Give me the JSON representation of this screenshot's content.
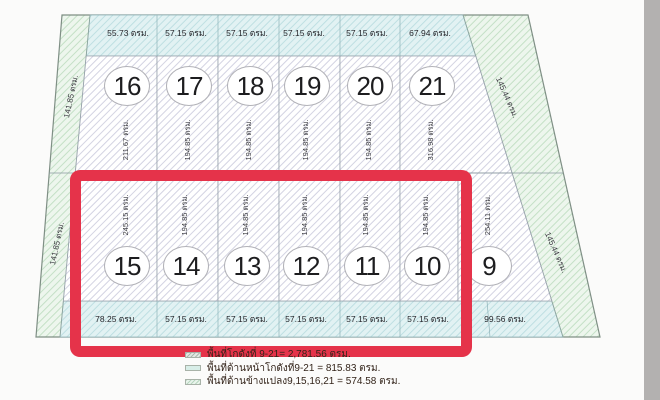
{
  "top_strip": [
    "55.73 ตรม.",
    "57.15 ตรม.",
    "57.15 ตรม.",
    "57.15 ตรม.",
    "57.15 ตรม.",
    "67.94 ตรม."
  ],
  "top_plots": [
    {
      "number": "16",
      "area": "211.67 ตรม."
    },
    {
      "number": "17",
      "area": "194.85 ตรม."
    },
    {
      "number": "18",
      "area": "194.85 ตรม."
    },
    {
      "number": "19",
      "area": "194.85 ตรม."
    },
    {
      "number": "20",
      "area": "194.85 ตรม."
    },
    {
      "number": "21",
      "area": "316.98 ตรม."
    }
  ],
  "bottom_plots": [
    {
      "number": "15",
      "area": "245.15 ตรม."
    },
    {
      "number": "14",
      "area": "194.85 ตรม."
    },
    {
      "number": "13",
      "area": "194.85 ตรม."
    },
    {
      "number": "12",
      "area": "194.85 ตรม."
    },
    {
      "number": "11",
      "area": "194.85 ตรม."
    },
    {
      "number": "10",
      "area": "194.85 ตรม."
    },
    {
      "number": "9",
      "area": "254.11 ตรม."
    }
  ],
  "bottom_strip": [
    "78.25 ตรม.",
    "57.15 ตรม.",
    "57.15 ตรม.",
    "57.15 ตรม.",
    "57.15 ตรม.",
    "57.15 ตรม.",
    "99.56 ตรม."
  ],
  "left_labels": [
    "141.85 ตรม.",
    "141.85 ตรม."
  ],
  "right_labels": [
    "145.44 ตรม.",
    "145.44 ตรม."
  ],
  "legend": [
    {
      "swatch": "warehouse-area-swatch",
      "text": "พื้นที่โกดังที่ 9-21= 2,781.56 ตรม."
    },
    {
      "swatch": "front-area-swatch",
      "text": "พื้นที่ด้านหน้าโกดังที่9-21 = 815.83 ตรม."
    },
    {
      "swatch": "side-area-swatch",
      "text": "พื้นที่ด้านข้างแปลง9,15,16,21 = 574.58 ตรม."
    }
  ],
  "colors": {
    "highlight_red": "#e5334a",
    "plot_hatch_line": "#d3d3e2",
    "side_strip_fill": "#edf6ed",
    "front_strip_fill": "#e2f2f3"
  }
}
